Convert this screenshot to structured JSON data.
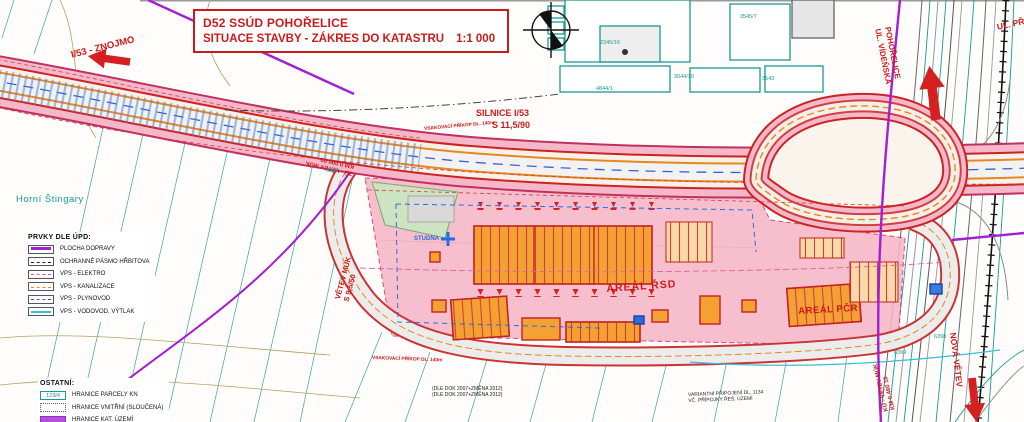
{
  "title_block": {
    "line1": "D52 SSÚD POHOŘELICE",
    "line2": "SITUACE STAVBY - ZÁKRES DO KATASTRU",
    "scale": "1:1 000"
  },
  "labels": {
    "znojmo": "I/53 - ZNOJMO",
    "silnice_1": "SILNICE I/53",
    "silnice_2": "S 11,5/90",
    "prikop": "VSAKOVACÍ PŘÍKOP DL. 140m",
    "vetev_1": "VĚTEV MÚK",
    "vetev_2": "S 9,5/50",
    "zu_1": "ZÚ - VĚTEV MÚK",
    "zu_2": "KM 0,000 00",
    "ku_1": "KÚ - VĚTEV MÚK",
    "ku_2": "KM 0,460 10",
    "areal_rsd": "AREÁL ŘSD",
    "areal_pcr": "AREÁL PČR",
    "pohorelice_1": "POHOŘELICE",
    "pohorelice_2": "UL. VÍDEŇSKÁ",
    "ul_pribicka": "UL. PŘ",
    "nova_vetev": "NOVÁ VĚTEV",
    "horni_stingary": "Horní Štingary",
    "studna": "STUDNA"
  },
  "notes": {
    "dok_1": "(DLE DOK 2007+ZMĚNA 2012)",
    "dok_2": "(DLE DOK 2007+ZMĚNA 2012)",
    "var_1": "VARIANTNÍ PŘIPOJENÍ DL. 1134",
    "var_2": "VČ. PŘÍPOJKY ŘEŠ. ÚZEMÍ"
  },
  "parcels": [
    "2345/16",
    "3545/7",
    "3044/10",
    "3543",
    "4844/1",
    "6384",
    "6398",
    "6399"
  ],
  "legend_upd": {
    "title": "PRVKY DLE ÚPD:",
    "items": [
      {
        "label": "PLOCHA DOPRAVY"
      },
      {
        "label": "OCHRANNÉ PÁSMO HŘBITOVA"
      },
      {
        "label": "VPS - ELEKTRO"
      },
      {
        "label": "VPS - KANALIZACE"
      },
      {
        "label": "VPS - PLYNOVOD"
      },
      {
        "label": "VPS - VODOVOD, VÝTLAK"
      }
    ]
  },
  "legend_ostatni": {
    "title": "OSTATNÍ:",
    "items": [
      {
        "label": "HRANICE PARCELY KN",
        "sample": "123/4"
      },
      {
        "label": "HRANICE VNITŘNÍ (SLOUČENÁ)"
      },
      {
        "label": "HRANICE KAT. ÚZEMÍ"
      }
    ]
  },
  "colors": {
    "accent_red": "#cc1a1a",
    "cadastral_teal": "#1a9a90",
    "upd_purple": "#a21fd4",
    "building_orange": "#f2a132",
    "site_pink": "#f6b4c6",
    "water_cyan": "#3bbfd4",
    "utility_blue": "#2b6be0"
  }
}
